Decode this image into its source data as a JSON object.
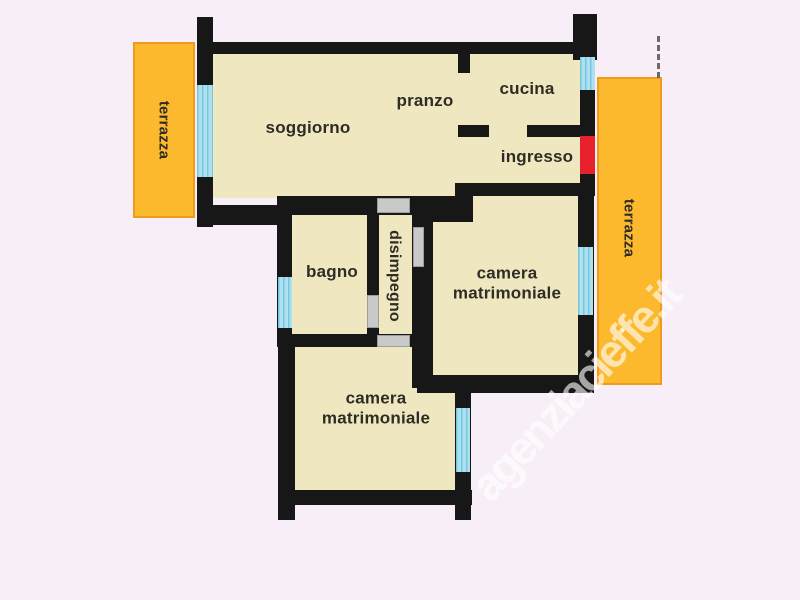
{
  "floorplan": {
    "rooms": {
      "soggiorno": "soggiorno",
      "pranzo": "pranzo",
      "cucina": "cucina",
      "ingresso": "ingresso",
      "bagno": "bagno",
      "disimpegno": "disimpegno",
      "camera": {
        "line1": "camera",
        "line2": "matrimoniale"
      }
    },
    "terraces": {
      "left": "terrazza",
      "right": "terrazza"
    },
    "watermark": "agenziacieffe.it",
    "colors": {
      "background": "#f8eef7",
      "wall": "#171717",
      "room_fill": "#efe7c0",
      "terrace": "#fcb92e",
      "terrace_border": "#ef9b1e",
      "window": "#aee0f0",
      "window_stripe": "#74c7de",
      "interior_door": "#c9c9c9",
      "entrance_door": "#e6212d",
      "label_text": "#2e2c25",
      "watermark_text": "#ffffff"
    }
  }
}
